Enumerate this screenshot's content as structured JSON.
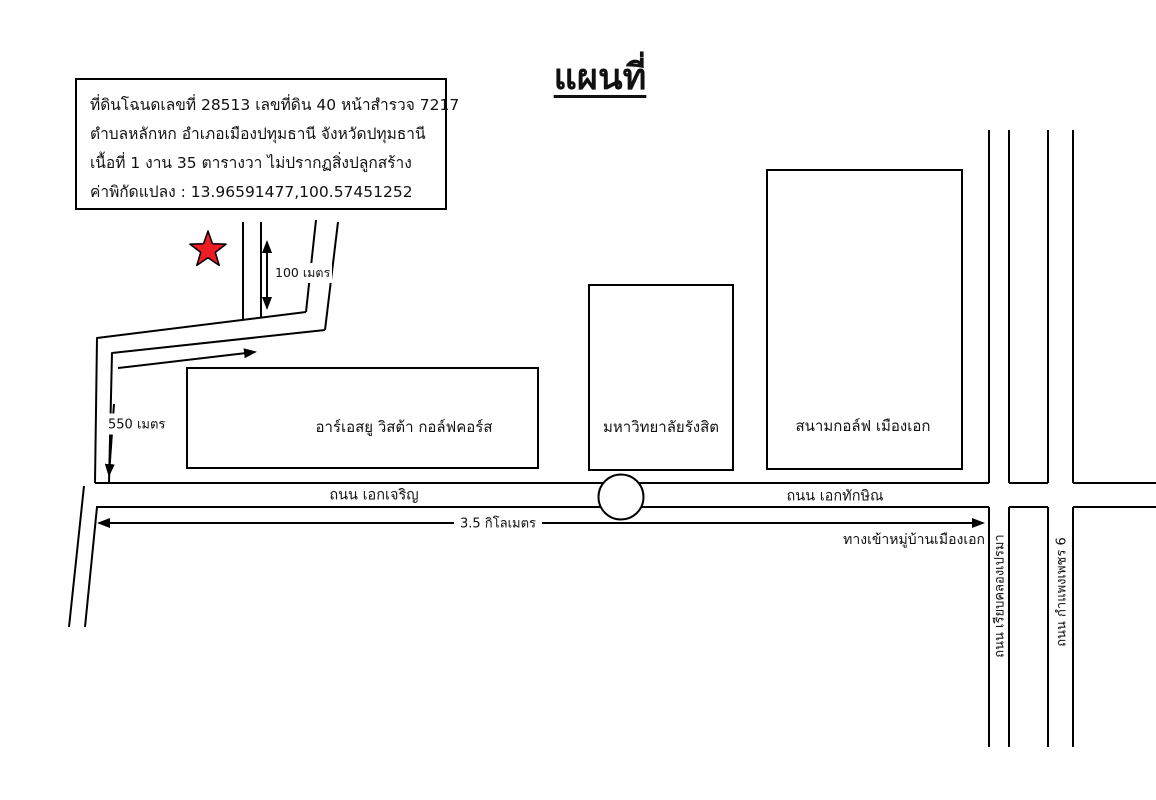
{
  "title": "แผนที่",
  "info_box": {
    "line1": "ที่ดินโฉนดเลขที่ 28513 เลขที่ดิน 40 หน้าสำรวจ 7217",
    "line2": "ตำบลหลักหก อำเภอเมืองปทุมธานี จังหวัดปทุมธานี",
    "line3": "เนื้อที่ 1 งาน 35 ตารางวา ไม่ปรากฏสิ่งปลูกสร้าง",
    "line4": "ค่าพิกัดแปลง : 13.96591477,100.57451252"
  },
  "landmarks": {
    "golf_west": "อาร์เอสยู วิสต้า กอล์ฟคอร์ส",
    "university": "มหาวิทยาลัยรังสิต",
    "golf_east": "สนามกอล์ฟ เมืองเอก"
  },
  "roads": {
    "ek_charoen": "ถนน เอกเจริญ",
    "ek_thaksin": "ถนน เอกทักษิณ",
    "khlong_prema": "ถนน เรียบคลองเปรมา",
    "kamphaeng_phet": "ถนน กำแพงเพชร 6"
  },
  "measurements": {
    "soi_length": "100 เมตร",
    "access_length": "550 เมตร",
    "main_length": "3.5 กิโลเมตร"
  },
  "notes": {
    "village_entrance": "ทางเข้าหมู่บ้านเมืองเอก"
  },
  "colors": {
    "star": "#ee1c25",
    "line": "#000000"
  }
}
